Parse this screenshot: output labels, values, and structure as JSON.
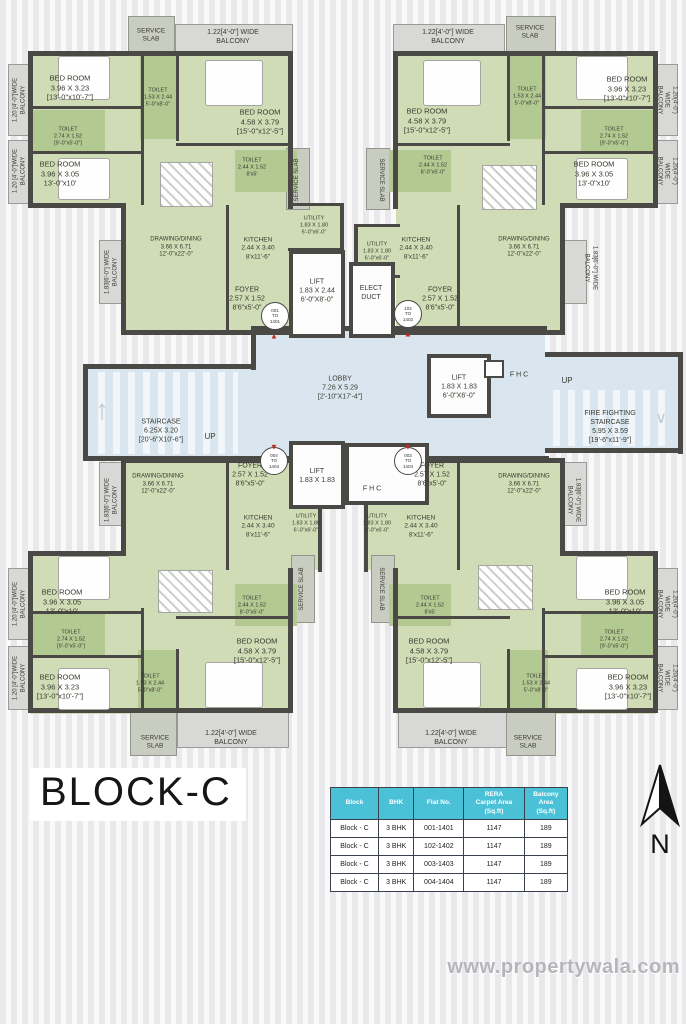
{
  "title": {
    "block_name": "BLOCK-C"
  },
  "compass": {
    "label": "N"
  },
  "watermark": {
    "text": "www.propertywala.com"
  },
  "icons": {
    "entry_up": "▲",
    "entry_down": "▼",
    "stair_up": "↑",
    "stair_down": "∨"
  },
  "colors": {
    "unit_floor": "#cfdcb5",
    "toilet_floor": "#b2c992",
    "core_floor": "#d9e6ef",
    "balcony": "#d8d8d6",
    "wall": "#4a4945",
    "table_header": "#4bc1d7",
    "entry_marker": "#c8271c"
  },
  "flat_table": {
    "headers": [
      "Block",
      "BHK",
      "Flat No.",
      "RERA\nCarpet Area\n(Sq.ft)",
      "Balcony\nArea\n(Sq.ft)"
    ],
    "rows": [
      [
        "Block - C",
        "3 BHK",
        "001-1401",
        "1147",
        "189"
      ],
      [
        "Block - C",
        "3 BHK",
        "102-1402",
        "1147",
        "189"
      ],
      [
        "Block - C",
        "3 BHK",
        "003-1403",
        "1147",
        "189"
      ],
      [
        "Block - C",
        "3 BHK",
        "004-1404",
        "1147",
        "189"
      ]
    ]
  },
  "plan": {
    "unit_circles": [
      {
        "n": "unit-number-001",
        "t": "001\nTO\n1401",
        "x": 275,
        "y": 316
      },
      {
        "n": "unit-number-102",
        "t": "102\nTO\n1402",
        "x": 408,
        "y": 314
      },
      {
        "n": "unit-number-004",
        "t": "004\nTO\n1404",
        "x": 274,
        "y": 461
      },
      {
        "n": "unit-number-003",
        "t": "003\nTO\n1403",
        "x": 408,
        "y": 461
      }
    ],
    "door_markers": [
      {
        "dir": "up",
        "x": 274,
        "y": 336
      },
      {
        "dir": "up",
        "x": 408,
        "y": 334
      },
      {
        "dir": "down",
        "x": 274,
        "y": 447
      },
      {
        "dir": "down",
        "x": 408,
        "y": 447
      }
    ],
    "labels": [
      {
        "n": "label-service-slab",
        "t": "SERVICE\nSLAB",
        "x": 151,
        "y": 36,
        "fs": 6.5
      },
      {
        "n": "label-balcony",
        "t": "1.22[4'-0\"] WIDE\nBALCONY",
        "x": 233,
        "y": 38,
        "fs": 7
      },
      {
        "n": "label-bedroom",
        "t": "BED ROOM\n3.96 X 3.23\n[13'-0\"x10'-7\"]",
        "x": 70,
        "y": 88,
        "fs": 7.5
      },
      {
        "n": "label-toilet",
        "t": "TOILET\n1.53 X 2.44\n5'-0\"x8'-0\"",
        "x": 158,
        "y": 98,
        "fs": 5.5
      },
      {
        "n": "label-bedroom",
        "t": "BED ROOM\n4.58 X 3.79\n[15'-0\"x12'-5\"]",
        "x": 260,
        "y": 122,
        "fs": 7.5
      },
      {
        "n": "label-toilet",
        "t": "TOILET\n2.74 X 1.52\n[9'-0\"x5'-0\"]",
        "x": 68,
        "y": 137,
        "fs": 5.5
      },
      {
        "n": "label-bedroom",
        "t": "BED ROOM\n3.96 X 3.05\n13'-0\"x10'",
        "x": 60,
        "y": 174,
        "fs": 7.5
      },
      {
        "n": "label-toilet",
        "t": "TOILET\n2.44 X 1.52\n8'x5'",
        "x": 252,
        "y": 168,
        "fs": 5.5
      },
      {
        "n": "label-balcony",
        "t": "1.20 [4'-0\"]WIDE\nBALCONY",
        "x": 20,
        "y": 100,
        "fs": 6,
        "rot": -90
      },
      {
        "n": "label-balcony",
        "t": "1.20 [4'-0\"]WIDE\nBALCONY",
        "x": 20,
        "y": 171,
        "fs": 6,
        "rot": -90
      },
      {
        "n": "label-drawing-dining",
        "t": "DRAWING/DINING\n3.66 X 6.71\n12'-0\"x22'-0\"",
        "x": 176,
        "y": 248,
        "fs": 6
      },
      {
        "n": "label-kitchen",
        "t": "KITCHEN\n2.44 X 3.40\n8'x11'-6\"",
        "x": 258,
        "y": 249,
        "fs": 6.5
      },
      {
        "n": "label-utility",
        "t": "UTILITY\n1.83 X 1.80\n6'-0\"x6'-0\"",
        "x": 314,
        "y": 226,
        "fs": 5.5
      },
      {
        "n": "label-service-slab",
        "t": "SERVICE SLAB",
        "x": 298,
        "y": 180,
        "fs": 6,
        "rot": -90
      },
      {
        "n": "label-balcony",
        "t": "1.83[6'-0\"] WIDE\nBALCONY",
        "x": 112,
        "y": 272,
        "fs": 6,
        "rot": -90
      },
      {
        "n": "label-foyer",
        "t": "FOYER\n2.57 X 1.52\n8'6\"x5'-0\"",
        "x": 247,
        "y": 300,
        "fs": 7
      },
      {
        "n": "label-lift",
        "t": "LIFT\n1.83 X 2.44\n6'-0\"X8'-0\"",
        "x": 317,
        "y": 292,
        "fs": 7
      },
      {
        "n": "label-elect-duct",
        "t": "ELECT\nDUCT",
        "x": 371,
        "y": 294,
        "fs": 7
      },
      {
        "n": "label-balcony",
        "t": "1.22[4'-0\"] WIDE\nBALCONY",
        "x": 448,
        "y": 38,
        "fs": 7
      },
      {
        "n": "label-service-slab",
        "t": "SERVICE\nSLAB",
        "x": 530,
        "y": 33,
        "fs": 6.5
      },
      {
        "n": "label-bedroom",
        "t": "BED ROOM\n3.96 X 3.23\n[13'-0\"x10'-7\"]",
        "x": 627,
        "y": 89,
        "fs": 7.5
      },
      {
        "n": "label-toilet",
        "t": "TOILET\n1.53 X 2.44\n5'-0\"x8'-0\"",
        "x": 527,
        "y": 97,
        "fs": 5.5
      },
      {
        "n": "label-bedroom",
        "t": "BED ROOM\n4.58 X 3.79\n[15'-0\"x12'-5\"]",
        "x": 427,
        "y": 121,
        "fs": 7.5
      },
      {
        "n": "label-toilet",
        "t": "TOILET\n2.74 X 1.52\n[9'-0\"x5'-0\"]",
        "x": 614,
        "y": 137,
        "fs": 5.5
      },
      {
        "n": "label-bedroom",
        "t": "BED ROOM\n3.96 X 3.05\n13'-0\"x10'",
        "x": 594,
        "y": 174,
        "fs": 7.5
      },
      {
        "n": "label-toilet",
        "t": "TOILET\n2.44 X 1.52\n8'-0\"x5'-0\"",
        "x": 433,
        "y": 166,
        "fs": 5.5
      },
      {
        "n": "label-balcony",
        "t": "1.20(4'-0\") WIDE\nBALCONY",
        "x": 666,
        "y": 100,
        "fs": 6,
        "rot": 90
      },
      {
        "n": "label-balcony",
        "t": "1.20(4'-0\") WIDE\nBALCONY",
        "x": 666,
        "y": 171,
        "fs": 6,
        "rot": 90
      },
      {
        "n": "label-service-slab",
        "t": "SERVICE SLAB",
        "x": 380,
        "y": 180,
        "fs": 6,
        "rot": 90
      },
      {
        "n": "label-utility",
        "t": "UTILITY\n1.83 X 1.80\n6'-0\"x6'-0\"",
        "x": 377,
        "y": 252,
        "fs": 5.5
      },
      {
        "n": "label-kitchen",
        "t": "KITCHEN\n2.44 X 3.40\n8'x11'-6\"",
        "x": 416,
        "y": 249,
        "fs": 6.5
      },
      {
        "n": "label-drawing-dining",
        "t": "DRAWING/DINING\n3.66 X 6.71\n12'-0\"x22'-0\"",
        "x": 524,
        "y": 248,
        "fs": 6
      },
      {
        "n": "label-balcony",
        "t": "1.83[6'-0\"] WIDE\nBALCONY",
        "x": 590,
        "y": 268,
        "fs": 6,
        "rot": 90
      },
      {
        "n": "label-foyer",
        "t": "FOYER\n2.57 X 1.52\n8'6\"x5'-0\"",
        "x": 440,
        "y": 300,
        "fs": 7
      },
      {
        "n": "label-staircase",
        "t": "STAIRCASE\n6.25X 3.20\n[20'-6\"X10'-6\"]",
        "x": 161,
        "y": 432,
        "fs": 7
      },
      {
        "n": "label-up",
        "t": "UP",
        "x": 210,
        "y": 437,
        "fs": 8
      },
      {
        "n": "label-lobby",
        "t": "LOBBY\n7.26 X 5.29\n[2'-10\"X17'-4\"]",
        "x": 340,
        "y": 389,
        "fs": 7
      },
      {
        "n": "label-lift",
        "t": "LIFT\n1.83 X 1.83\n6'-0\"X6'-0\"",
        "x": 459,
        "y": 388,
        "fs": 7
      },
      {
        "n": "label-fhc",
        "t": "F H C",
        "x": 519,
        "y": 376,
        "fs": 7
      },
      {
        "n": "label-up",
        "t": "UP",
        "x": 567,
        "y": 381,
        "fs": 8
      },
      {
        "n": "label-fire-staircase",
        "t": "FIRE FIGHTING\nSTAIRCASE\n5.95 X 3.59\n[19'-6\"x11'-9\"]",
        "x": 610,
        "y": 428,
        "fs": 7
      },
      {
        "n": "label-lift",
        "t": "LIFT\n1.83 X 1.83",
        "x": 317,
        "y": 477,
        "fs": 7
      },
      {
        "n": "label-fhc",
        "t": "F H C",
        "x": 372,
        "y": 490,
        "fs": 7
      },
      {
        "n": "label-foyer",
        "t": "FOYER\n2.57 X 1.52\n8'6\"x5'-0\"",
        "x": 250,
        "y": 476,
        "fs": 7
      },
      {
        "n": "label-drawing-dining",
        "t": "DRAWING/DINING\n3.66 X 6.71\n12'-0\"x22'-0\"",
        "x": 158,
        "y": 485,
        "fs": 6
      },
      {
        "n": "label-balcony",
        "t": "1.83[6'-0\"] WIDE\nBALCONY",
        "x": 112,
        "y": 500,
        "fs": 6,
        "rot": -90
      },
      {
        "n": "label-kitchen",
        "t": "KITCHEN\n2.44 X 3.40\n8'x11'-6\"",
        "x": 258,
        "y": 527,
        "fs": 6.5
      },
      {
        "n": "label-utility",
        "t": "UTILITY\n1.83 X 1.80\n6'-0\"x6'-0\"",
        "x": 306,
        "y": 524,
        "fs": 5.5
      },
      {
        "n": "label-service-slab",
        "t": "SERVICE SLAB",
        "x": 303,
        "y": 589,
        "fs": 6,
        "rot": -90
      },
      {
        "n": "label-toilet",
        "t": "TOILET\n2.44 X 1.52\n8'-0\"x5'-0\"",
        "x": 252,
        "y": 606,
        "fs": 5.5
      },
      {
        "n": "label-bedroom",
        "t": "BED ROOM\n4.58 X 3.79\n[15'-0\"x12'-5\"]",
        "x": 257,
        "y": 651,
        "fs": 7.5
      },
      {
        "n": "label-bedroom",
        "t": "BED ROOM\n3.96 X 3.05\n13'-0\"x10'",
        "x": 62,
        "y": 602,
        "fs": 7.5
      },
      {
        "n": "label-toilet",
        "t": "TOILET\n2.74 X 1.52\n[9'-0\"x5'-0\"]",
        "x": 71,
        "y": 640,
        "fs": 5.5
      },
      {
        "n": "label-bedroom",
        "t": "BED ROOM\n3.96 X 3.23\n[13'-0\"x10'-7\"]",
        "x": 60,
        "y": 687,
        "fs": 7.5
      },
      {
        "n": "label-toilet",
        "t": "TOILET\n1.53 X 2.44\n5'-0\"x8'-0\"",
        "x": 150,
        "y": 684,
        "fs": 5.5
      },
      {
        "n": "label-service-slab",
        "t": "SERVICE\nSLAB",
        "x": 155,
        "y": 743,
        "fs": 6.5
      },
      {
        "n": "label-balcony",
        "t": "1.22[4'-0\"] WIDE\nBALCONY",
        "x": 231,
        "y": 739,
        "fs": 7
      },
      {
        "n": "label-balcony",
        "t": "1.20 [4'-0\"]WIDE\nBALCONY",
        "x": 20,
        "y": 604,
        "fs": 6,
        "rot": -90
      },
      {
        "n": "label-balcony",
        "t": "1.20 [4'-0\"]WIDE\nBALCONY",
        "x": 20,
        "y": 678,
        "fs": 6,
        "rot": -90
      },
      {
        "n": "label-foyer",
        "t": "FOYER\n2.57 X 1.52\n8'6\"x5'-0\"",
        "x": 432,
        "y": 476,
        "fs": 7
      },
      {
        "n": "label-drawing-dining",
        "t": "DRAWING/DINING\n3.66 X 6.71\n12'-0\"x22'-0\"",
        "x": 524,
        "y": 485,
        "fs": 6
      },
      {
        "n": "label-balcony",
        "t": "1.83[6'-0\"] WIDE\nBALCONY",
        "x": 573,
        "y": 500,
        "fs": 6,
        "rot": 90
      },
      {
        "n": "label-kitchen",
        "t": "KITCHEN\n2.44 X 3.40\n8'x11'-6\"",
        "x": 421,
        "y": 527,
        "fs": 6.5
      },
      {
        "n": "label-utility",
        "t": "UTILITY\n1.83 X 1.80\n6'-0\"x6'-0\"",
        "x": 377,
        "y": 524,
        "fs": 5.5
      },
      {
        "n": "label-service-slab",
        "t": "SERVICE SLAB",
        "x": 380,
        "y": 589,
        "fs": 6,
        "rot": 90
      },
      {
        "n": "label-toilet",
        "t": "TOILET\n2.44 X 1.52\n8'x5'",
        "x": 430,
        "y": 606,
        "fs": 5.5
      },
      {
        "n": "label-bedroom",
        "t": "BED ROOM\n4.58 X 3.79\n[15'-0\"x12'-5\"]",
        "x": 429,
        "y": 651,
        "fs": 7.5
      },
      {
        "n": "label-bedroom",
        "t": "BED ROOM\n3.96 X 3.05\n13'-0\"x10'",
        "x": 625,
        "y": 602,
        "fs": 7.5
      },
      {
        "n": "label-toilet",
        "t": "TOILET\n2.74 X 1.52\n[9'-0\"x5'-0\"]",
        "x": 614,
        "y": 640,
        "fs": 5.5
      },
      {
        "n": "label-bedroom",
        "t": "BED ROOM\n3.96 X 3.23\n[13'-0\"x10'-7\"]",
        "x": 628,
        "y": 687,
        "fs": 7.5
      },
      {
        "n": "label-toilet",
        "t": "TOILET\n1.53 X 2.44\n5'-0\"x8'-0\"",
        "x": 536,
        "y": 684,
        "fs": 5.5
      },
      {
        "n": "label-balcony",
        "t": "1.22[4'-0\"] WIDE\nBALCONY",
        "x": 451,
        "y": 739,
        "fs": 7
      },
      {
        "n": "label-service-slab",
        "t": "SERVICE\nSLAB",
        "x": 528,
        "y": 743,
        "fs": 6.5
      },
      {
        "n": "label-balcony",
        "t": "1.20(4'-0\") WIDE\nBALCONY",
        "x": 666,
        "y": 604,
        "fs": 6,
        "rot": 90
      },
      {
        "n": "label-balcony",
        "t": "1.20(4'-0\") WIDE\nBALCONY",
        "x": 666,
        "y": 678,
        "fs": 6,
        "rot": 90
      }
    ]
  }
}
